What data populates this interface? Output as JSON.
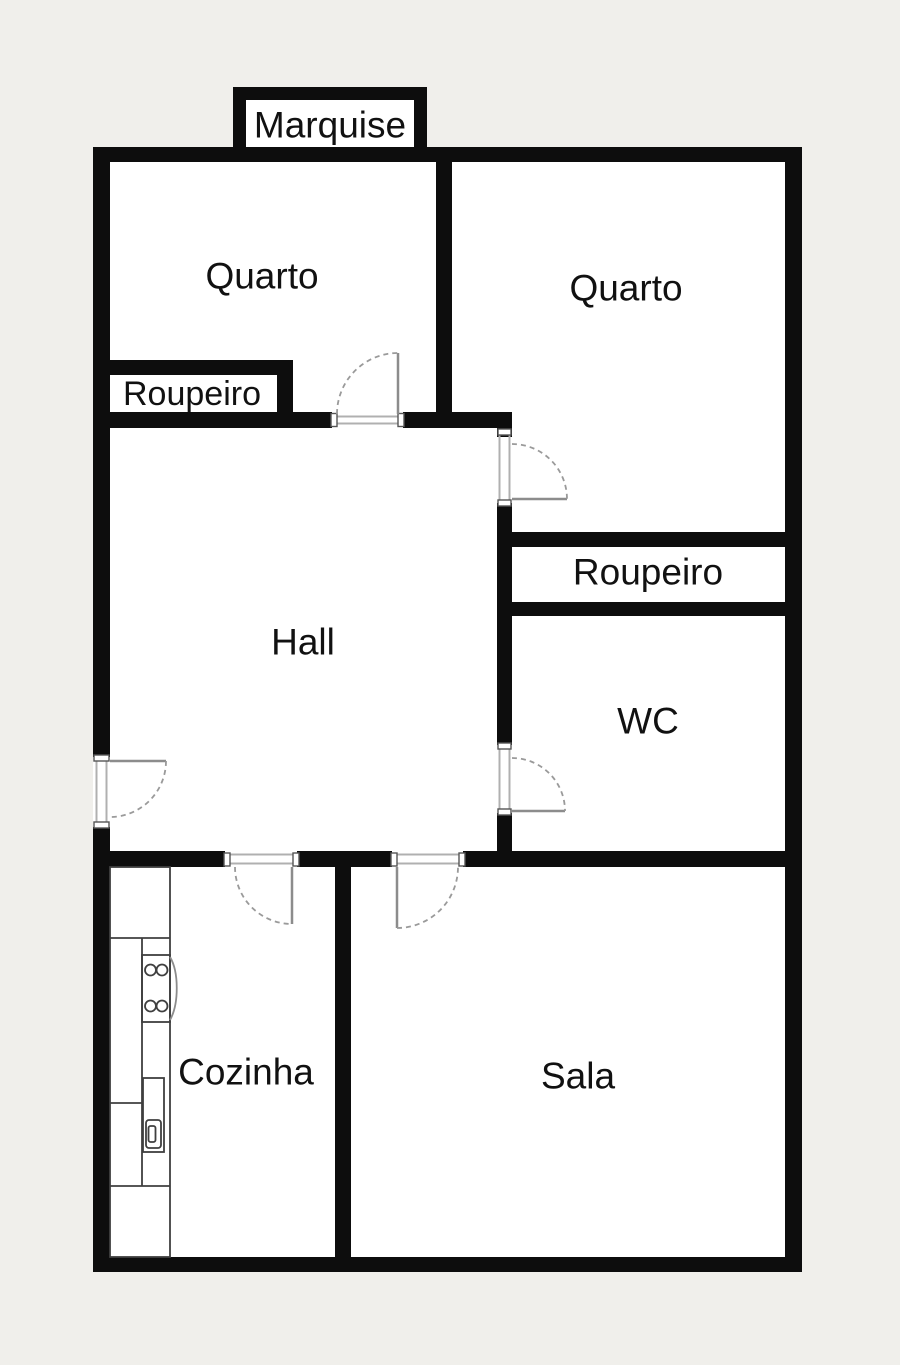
{
  "plan": {
    "type": "apartment-floor-plan",
    "outside_color": "#f0efeb",
    "wall_color": "#0d0d0d",
    "floor_color": "#ffffff",
    "label_color": "#111111",
    "rooms": [
      {
        "id": "marquise",
        "label": "Marquise"
      },
      {
        "id": "quarto-left",
        "label": "Quarto"
      },
      {
        "id": "quarto-right",
        "label": "Quarto"
      },
      {
        "id": "roupeiro-left",
        "label": "Roupeiro"
      },
      {
        "id": "hall",
        "label": "Hall"
      },
      {
        "id": "roupeiro-right",
        "label": "Roupeiro"
      },
      {
        "id": "wc",
        "label": "WC"
      },
      {
        "id": "cozinha",
        "label": "Cozinha"
      },
      {
        "id": "sala",
        "label": "Sala"
      }
    ]
  }
}
